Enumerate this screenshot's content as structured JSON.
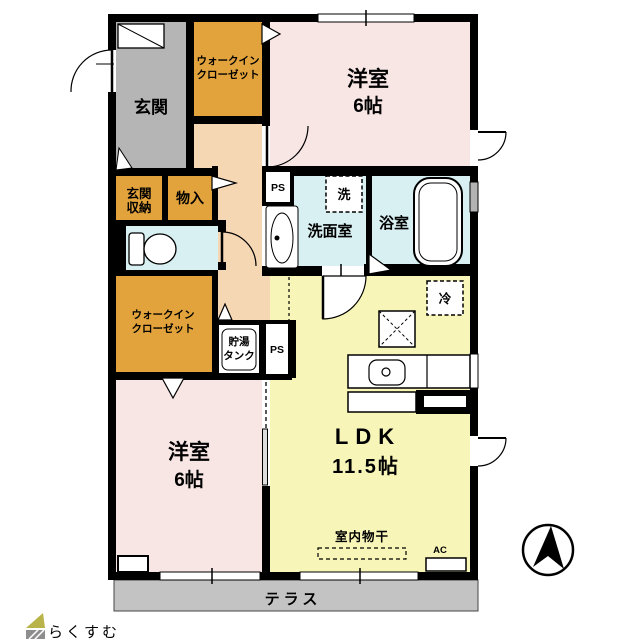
{
  "plan": {
    "labels": {
      "genkan": "玄関",
      "wic_line1": "ウォークイン",
      "wic_line2": "クローゼット",
      "bedroom": "洋室",
      "bedroom_size": "6帖",
      "genkan_storage_line1": "玄関",
      "genkan_storage_line2": "収納",
      "storage": "物入",
      "washer": "洗",
      "washroom": "洗面室",
      "bathroom": "浴室",
      "pipe_space": "PS",
      "tank_line1": "貯湯",
      "tank_line2": "タンク",
      "fridge": "冷",
      "ldk": "LDK",
      "ldk_size": "11.5帖",
      "indoor_laundry": "室内物干",
      "ac": "AC",
      "terrace": "テラス"
    },
    "logo_text": "らくすむ",
    "colors": {
      "wall": "#000000",
      "closet_orange": "#e2a33c",
      "bedroom_pink": "#f8e6e5",
      "corridor_peach": "#f6d7b4",
      "wet_blue": "#d8f0f2",
      "ldk_yellow": "#f7f5b8",
      "genkan_gray": "#b5b5b5",
      "terrace_gray": "#c3c3c3",
      "logo_brown": "#c9a093",
      "logo_roof_green": "#b9b44a"
    }
  }
}
